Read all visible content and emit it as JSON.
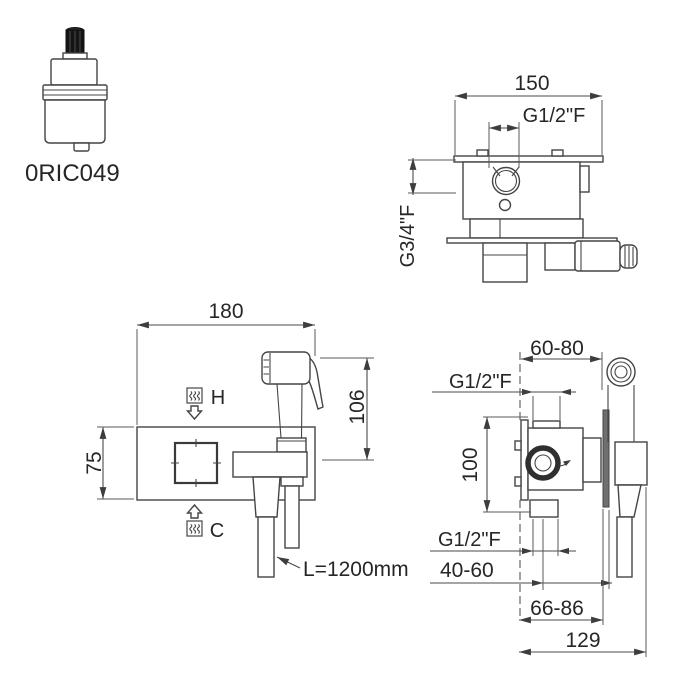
{
  "meta": {
    "background_color": "#ffffff",
    "line_color": "#454545",
    "text_color": "#262626",
    "stem_fill": "#151515",
    "plate_fill": "#6f6f6f"
  },
  "cartridge": {
    "code": "0RIC049"
  },
  "top_view": {
    "width": "150",
    "top_outlet_thread": "G1/2\"F",
    "side_outlet_thread": "G3/4\"F"
  },
  "front_view": {
    "plate_width": "180",
    "plate_height": "75",
    "handshower_height": "106",
    "hot_label": "H",
    "cold_label": "C",
    "hose_length": "L=1200mm"
  },
  "side_view": {
    "depth_adjust_range": "60-80",
    "top_inlet_thread": "G1/2\"F",
    "inlet_spacing": "100",
    "bottom_outlet_thread": "G1/2\"F",
    "outlet_to_wall_range": "40-60",
    "plate_recess_range": "66-86",
    "total_depth": "129"
  }
}
